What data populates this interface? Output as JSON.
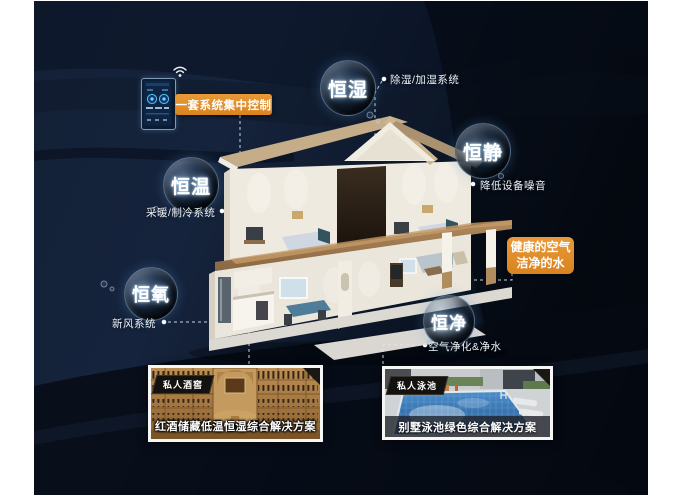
{
  "colors": {
    "accent_orange": "#e2902d",
    "background_navy": "#0c1626",
    "label_text": "#eef3f8",
    "sphere_glow": "#5a96d2",
    "pool_water": "#3a7bbf",
    "wine_wood": "#b58a50"
  },
  "control": {
    "callout": "一套系统集中控制",
    "device": "smart-home-controller",
    "wifi_icon": "wifi-icon"
  },
  "benefit_callout": {
    "line1": "健康的空气",
    "line2": "洁净的水"
  },
  "features": [
    {
      "bubble": "恒湿",
      "label": "除湿/加湿系统"
    },
    {
      "bubble": "恒静",
      "label": "降低设备噪音"
    },
    {
      "bubble": "恒温",
      "label": "采暖/制冷系统"
    },
    {
      "bubble": "恒氧",
      "label": "新风系统"
    },
    {
      "bubble": "恒净",
      "label": "空气净化&净水"
    }
  ],
  "photos": [
    {
      "tag": "私人酒窖",
      "caption": "红酒储藏低温恒湿综合解决方案"
    },
    {
      "tag": "私人泳池",
      "caption": "别墅泳池绿色综合解决方案"
    }
  ]
}
